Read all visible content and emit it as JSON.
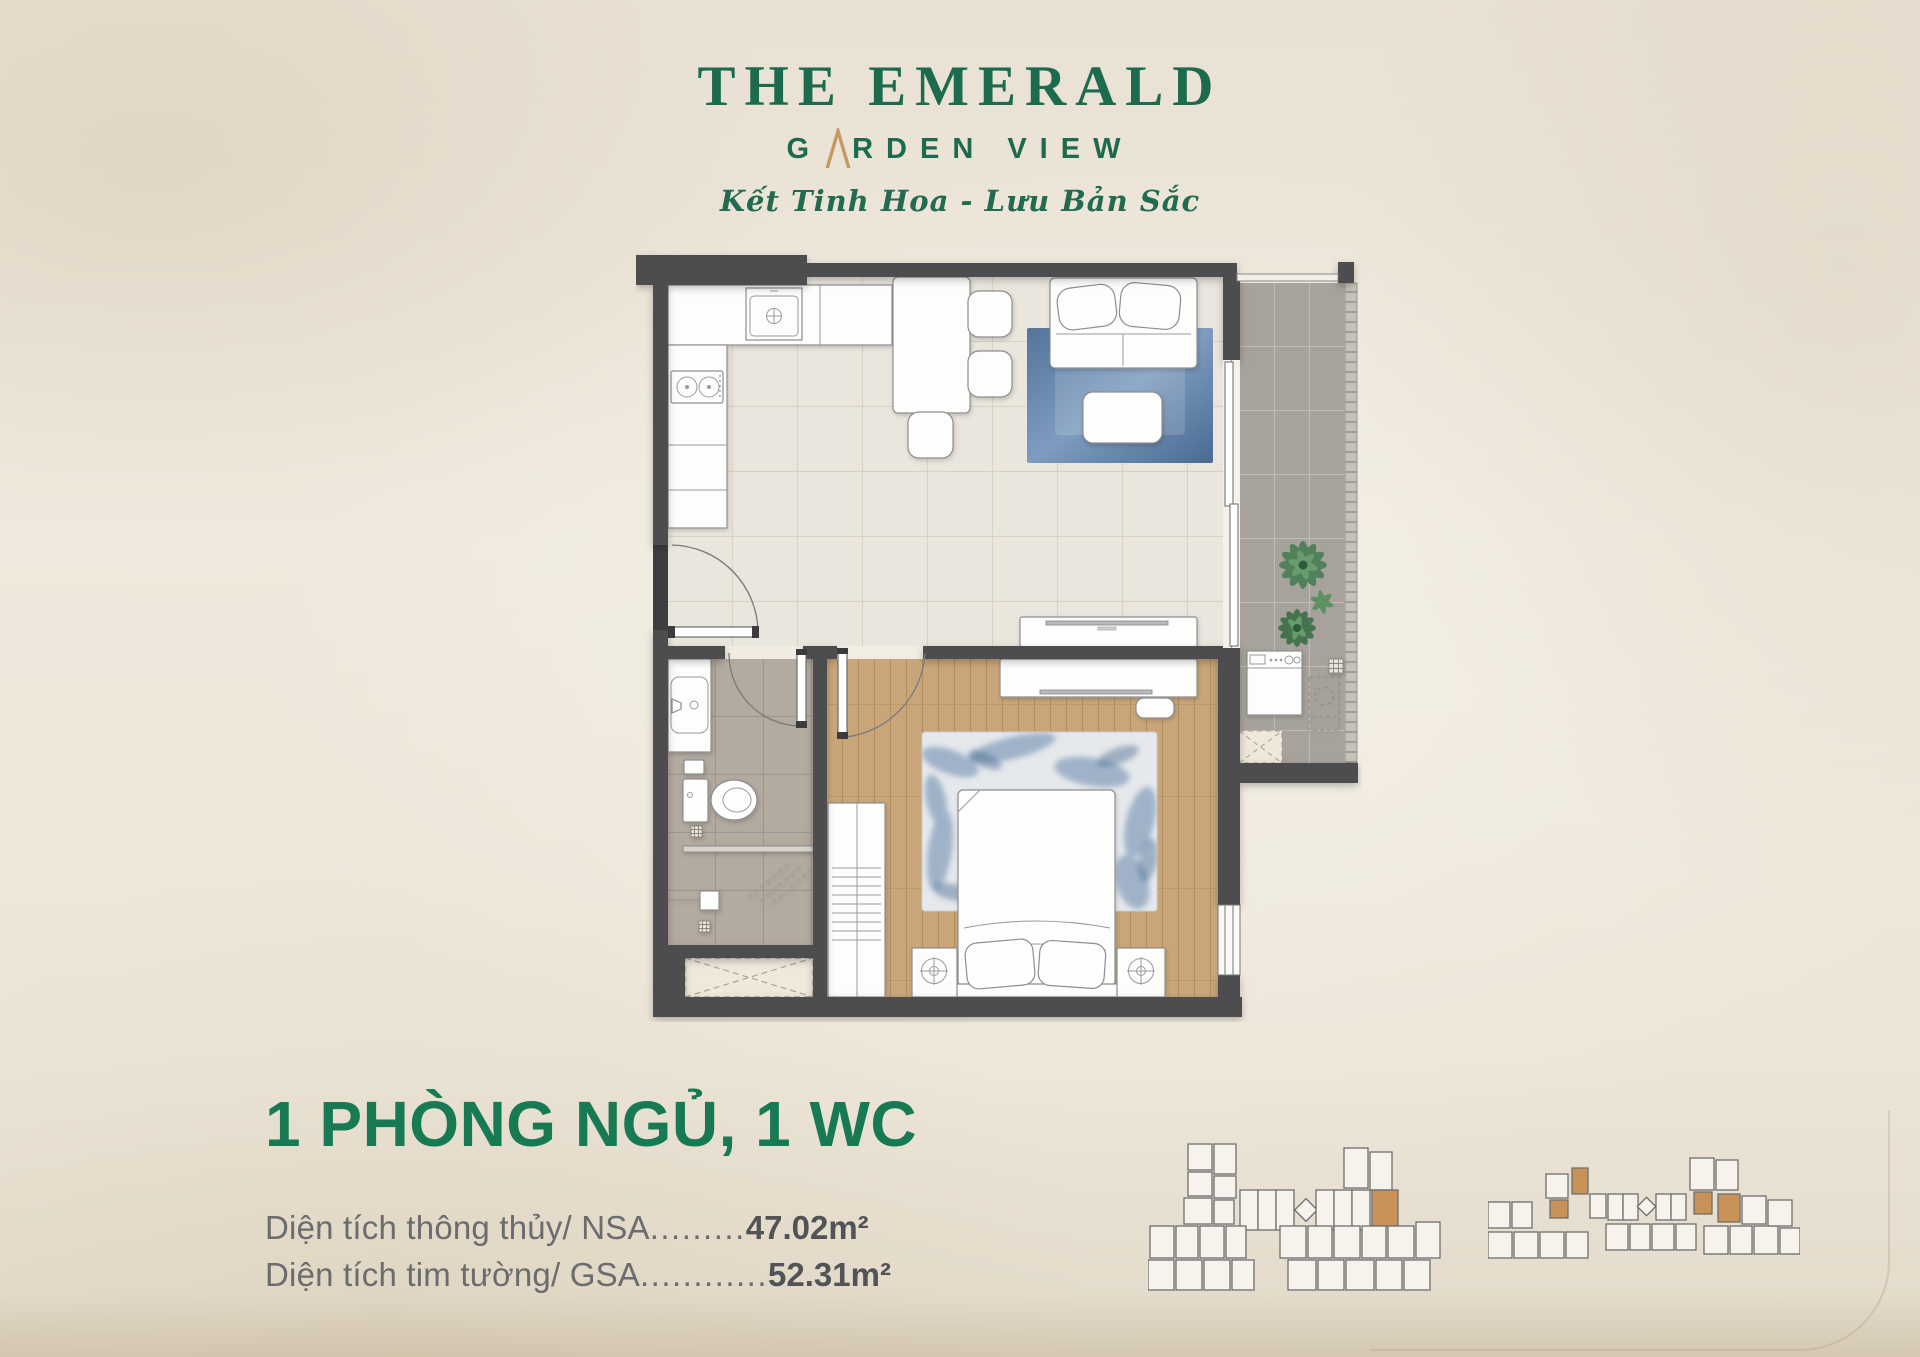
{
  "brand": {
    "name": "THE EMERALD",
    "sub_pre": "G",
    "sub_post": "RDEN VIEW",
    "tagline": "Kết Tinh Hoa - Lưu Bản Sắc"
  },
  "unit": {
    "title": "1 PHÒNG NGỦ, 1 WC",
    "areas": [
      {
        "label": "Diện tích thông thủy/ NSA",
        "dots": ".........",
        "value": "47.02m²"
      },
      {
        "label": "Diện tích tim tường/ GSA",
        "dots": "............",
        "value": "52.31m²"
      }
    ]
  },
  "colors": {
    "brand_green": "#1d6b4e",
    "title_green": "#177a54",
    "gold": "#c59a62",
    "text_gray": "#6b6c6e",
    "value_gray": "#525356",
    "wall": "#4e4e50",
    "hl": "#c79157",
    "bg": "#eae2d4"
  }
}
